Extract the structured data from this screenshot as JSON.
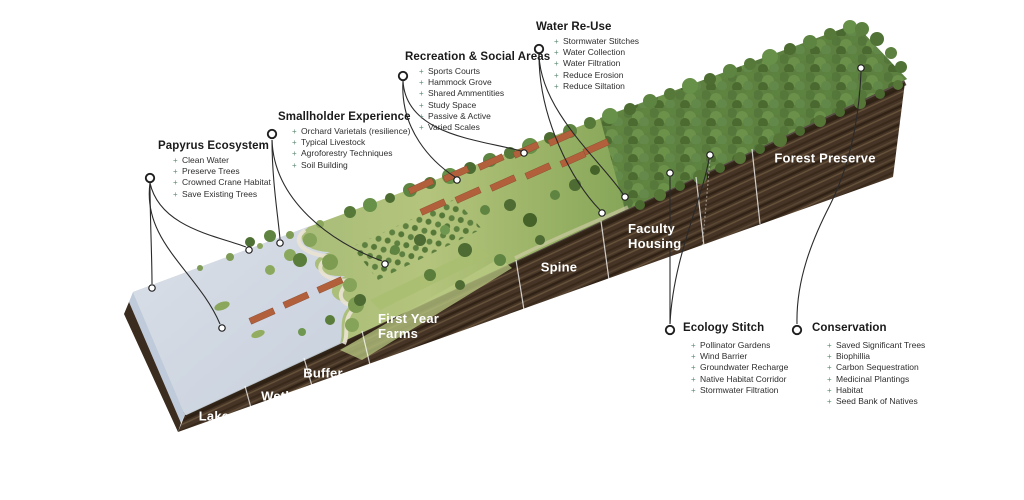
{
  "bullet_char": "+",
  "colors": {
    "background": "#ffffff",
    "canopy_green": "#5d8040",
    "grass_green": "#a9bd79",
    "lake_blue": "#d6dbe4",
    "soil_brown": "#463526",
    "roof_terracotta": "#b2603c",
    "label_text": "#1a1a1a",
    "section_label_text": "#ffffff"
  },
  "callouts": [
    {
      "id": "papyrus-ecosystem",
      "title": "Papyrus Ecosystem",
      "items": [
        "Clean Water",
        "Preserve Trees",
        "Crowned Crane Habitat",
        "Save Existing Trees"
      ]
    },
    {
      "id": "smallholder-experience",
      "title": "Smallholder Experience",
      "items": [
        "Orchard Varietals (resilience)",
        "Typical Livestock",
        "Agroforestry Techniques",
        "Soil Building"
      ]
    },
    {
      "id": "recreation-social-areas",
      "title": "Recreation & Social Areas",
      "items": [
        "Sports Courts",
        "Hammock Grove",
        "Shared Ammentities",
        "Study Space",
        "Passive & Active",
        "Varied Scales"
      ]
    },
    {
      "id": "water-re-use",
      "title": "Water Re-Use",
      "items": [
        "Stormwater Stitches",
        "Water Collection",
        "Water Filtration",
        "Reduce Erosion",
        "Reduce Siltation"
      ]
    },
    {
      "id": "ecology-stitch",
      "title": "Ecology Stitch",
      "items": [
        "Pollinator Gardens",
        "Wind Barrier",
        "Groundwater Recharge",
        "Native Habitat Corridor",
        "Stormwater Filtration"
      ]
    },
    {
      "id": "conservation",
      "title": "Conservation",
      "items": [
        "Saved Significant Trees",
        "Biophillia",
        "Carbon Sequestration",
        "Medicinal Plantings",
        "Habitat",
        "Seed Bank of Natives"
      ]
    }
  ],
  "section_labels": [
    {
      "id": "lake",
      "text": "Lake"
    },
    {
      "id": "wetland",
      "text": "Wetland"
    },
    {
      "id": "buffer",
      "text": "Buffer"
    },
    {
      "id": "first-year-farms",
      "text": "First Year Farms"
    },
    {
      "id": "spine",
      "text": "Spine"
    },
    {
      "id": "faculty-housing",
      "text": "Faculty Housing"
    },
    {
      "id": "forest-preserve",
      "text": "Forest Preserve"
    }
  ]
}
